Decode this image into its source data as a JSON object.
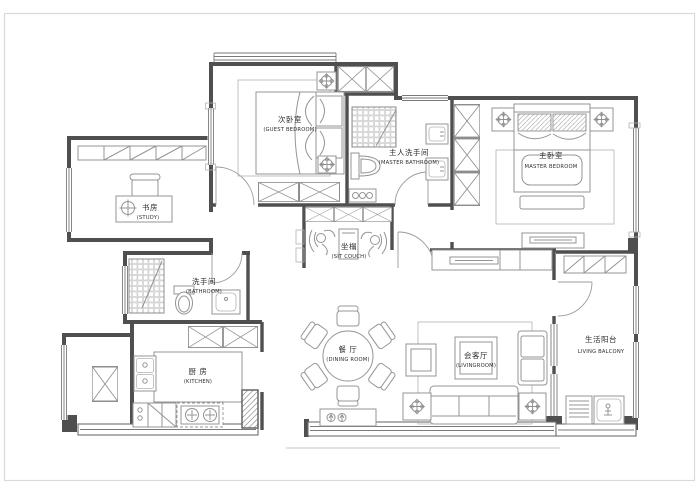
{
  "drawing": {
    "type": "apartment-floor-plan",
    "colors": {
      "background": "#ffffff",
      "frame": "#d9d9d9",
      "wall": "#4f4f4f",
      "furniture": "#949494",
      "text": "#2e2e2e"
    },
    "rooms": [
      {
        "key": "guest-bedroom",
        "zh": "次卧室",
        "en": "(GUEST BEDROOM)"
      },
      {
        "key": "master-bathroom",
        "zh": "主人洗手间",
        "en": "(MASTER BATHROOM)"
      },
      {
        "key": "master-bedroom",
        "zh": "主卧室",
        "en": "MASTER BEDROOM"
      },
      {
        "key": "study",
        "zh": "书房",
        "en": "(STUDY)"
      },
      {
        "key": "bathroom",
        "zh": "洗手间",
        "en": "(BATHROOM)"
      },
      {
        "key": "kitchen",
        "zh": "厨 房",
        "en": "(KITCHEN)"
      },
      {
        "key": "dining-room",
        "zh": "餐 厅",
        "en": "(DINING ROOM)"
      },
      {
        "key": "living-room",
        "zh": "会客厅",
        "en": "(LIVINGROOM)"
      },
      {
        "key": "sit-couch",
        "zh": "坐榻",
        "en": "(SIT COUCH)"
      },
      {
        "key": "living-balcony",
        "zh": "生活阳台",
        "en": "LIVING BALCONY"
      }
    ]
  }
}
